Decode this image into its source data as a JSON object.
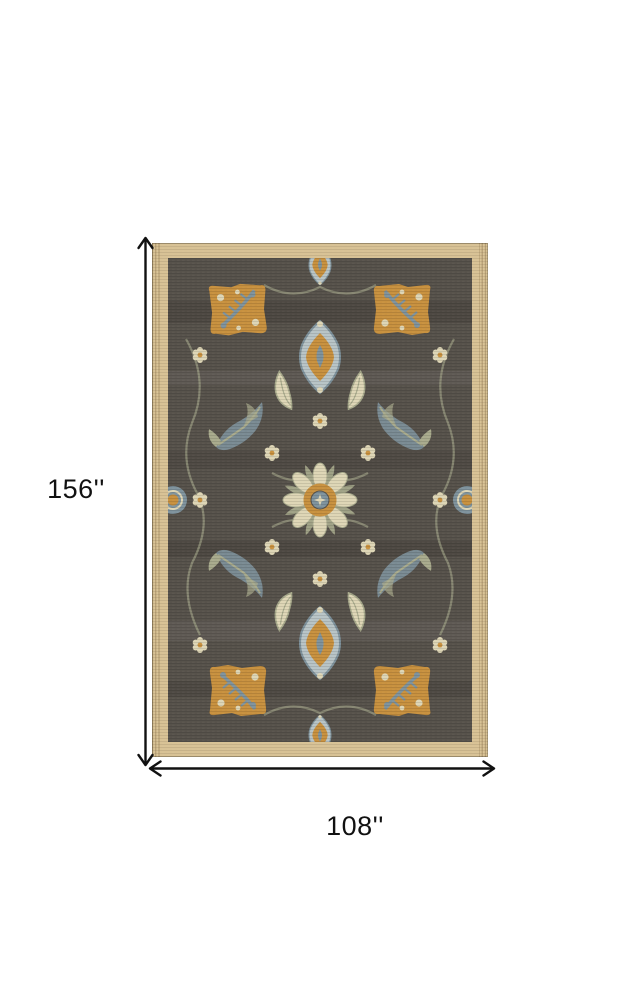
{
  "page": {
    "type": "product-dimension-diagram",
    "background": "#ffffff",
    "image_alt": "Ornate traditional area rug with tan woven border, dark taupe field, gold corner medallions, central rosette and slate-blue floral motifs"
  },
  "dimensions": {
    "height_label": "156''",
    "width_label": "108''"
  },
  "colors": {
    "background": "#ffffff",
    "text": "#111111",
    "line": "#111111",
    "border": "#d8c295",
    "border_dark": "#b9a06e",
    "field": "#57524b",
    "orange": "#c8913f",
    "slate": "#7f939d",
    "lightblue": "#b8c4c6",
    "sage": "#a9ab8d",
    "cream": "#ded6b6"
  }
}
